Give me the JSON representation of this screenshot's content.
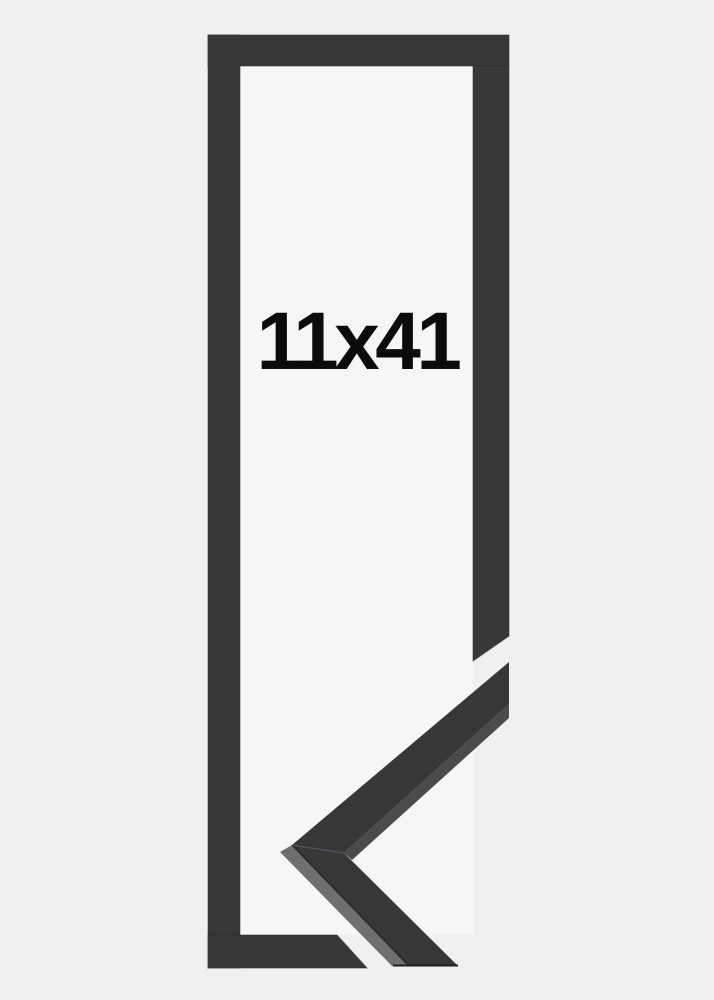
{
  "product": {
    "size_label": "11x41"
  },
  "scene": {
    "description": "Tall narrow black picture frame shown empty, with a mitered corner moulding profile detail overlapping the lower right",
    "frame_orientation": "portrait"
  },
  "colors": {
    "background": "#f0f0ef",
    "frame_opening": "#f6f6f5",
    "frame_face": "#38383b",
    "frame_edge": "#29292b",
    "moulding_side_gray": "#6f6f72",
    "moulding_side_dark": "#4b4b4e",
    "label_text": "#0b0b0b"
  }
}
